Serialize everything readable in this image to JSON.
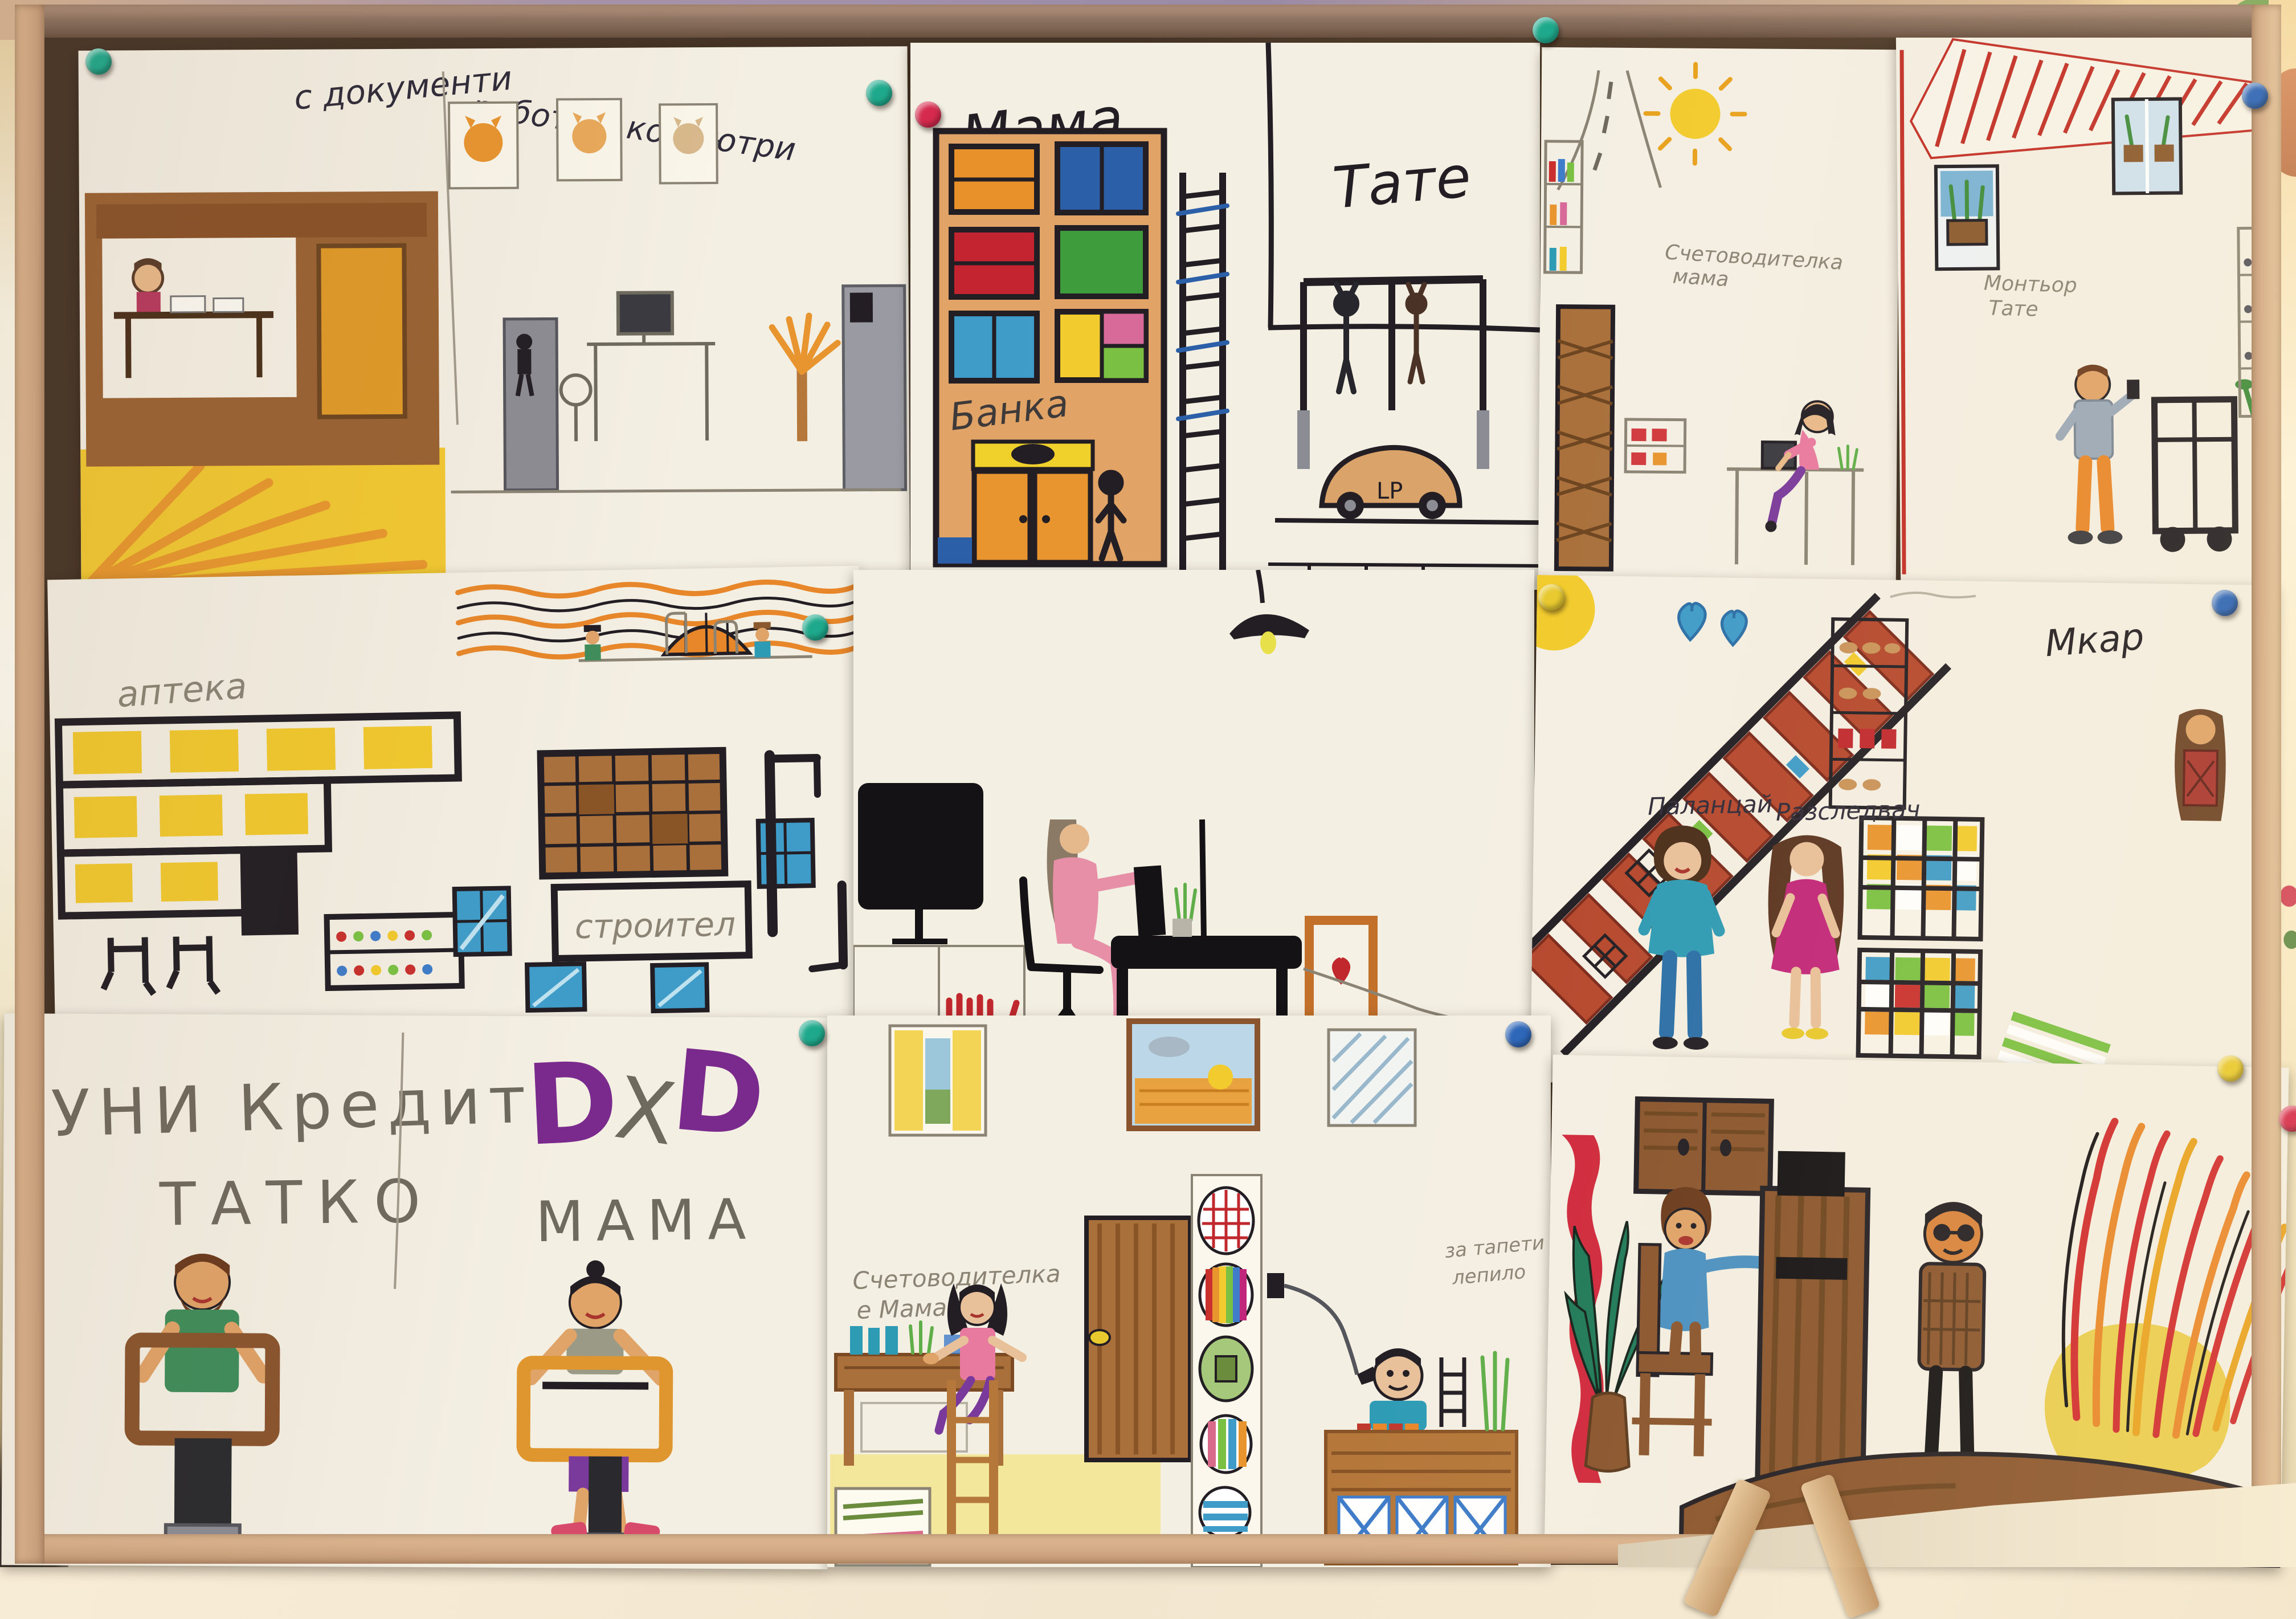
{
  "captions": {
    "s1_left": "с документи",
    "s1_right": "работи с компютри",
    "s2_mama": "Мама",
    "s2_tate": "Тате",
    "s2_banka": "Банка",
    "s2_car": "LP",
    "s3_line1": "Счетоводителка",
    "s3_line2": "мама",
    "s4_line1": "Монтьор",
    "s4_line2": "Тате",
    "s5_apteka": "аптека",
    "s5_stroitel": "строител",
    "s7_mkar": "Мкар",
    "s7_policeman": "Паланцай",
    "s7_detective": "Разследвач",
    "s8_line1": "УНИ Кредит",
    "s8_line2": "ТАТКО",
    "s8_d1": "D",
    "s8_x": "X",
    "s8_d2": "D",
    "s8_mama": "МАМА",
    "s9_line1": "Счетоводителка",
    "s9_line2": "е Мама",
    "s9_tapeti": "тапети",
    "s9_lepilo1": "за тапети",
    "s9_lepilo2": "лепило"
  },
  "pins": [
    {
      "location": "top-left sheet corner",
      "color_name": "green",
      "hex": "#1fa98c"
    },
    {
      "location": "between sheet 1 and 2 top",
      "color_name": "green",
      "hex": "#1fa98c"
    },
    {
      "location": "between sheet 1 and 2 top",
      "color_name": "red",
      "hex": "#d5294d"
    },
    {
      "location": "top middle board edge",
      "color_name": "green",
      "hex": "#1fa98c"
    },
    {
      "location": "top right corner",
      "color_name": "blue",
      "hex": "#2b64b8"
    },
    {
      "location": "middle row left seam",
      "color_name": "green",
      "hex": "#1fa98c"
    },
    {
      "location": "middle row center seam (on sun)",
      "color_name": "yellow",
      "hex": "#e8c92e"
    },
    {
      "location": "middle row right corner",
      "color_name": "blue",
      "hex": "#2b64b8"
    },
    {
      "location": "bottom row left seam",
      "color_name": "green",
      "hex": "#1fa98c"
    },
    {
      "location": "bottom row center seam",
      "color_name": "blue",
      "hex": "#2b64b8"
    },
    {
      "location": "bottom right sheet corner",
      "color_name": "yellow",
      "hex": "#e8c92e"
    },
    {
      "location": "right board edge",
      "color_name": "red",
      "hex": "#d5294d"
    }
  ],
  "palette": {
    "paper": "#f4efe3",
    "cork": "#503c2b",
    "frame_wood": "#c79d7b",
    "marker_black": "#221e24",
    "pencil_grey": "#8b8475",
    "brown": "#8a552e",
    "orange": "#e8952f",
    "yellow": "#f2c92e",
    "red": "#c9302e",
    "blue": "#3f7cc9",
    "teal": "#2e9bb5",
    "green": "#3f8c5a",
    "pink": "#e88fa8",
    "magenta": "#c2267a",
    "purple": "#7a2a8c"
  }
}
